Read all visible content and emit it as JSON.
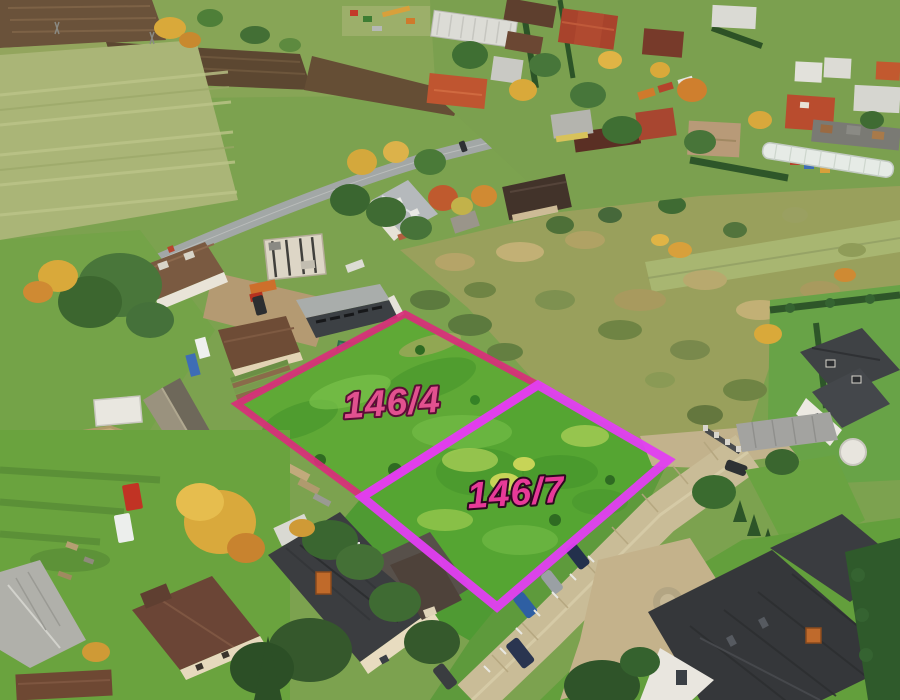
{
  "scene": {
    "type": "aerial-drone-photo",
    "subject": "building-plots-in-village"
  },
  "annotations": {
    "plots": [
      {
        "id": "146-4",
        "label": "146/4",
        "outline_color": "#d92e7b",
        "outline_width": "7",
        "label_fill": "#e2518f",
        "label_outline": "#5c0d36"
      },
      {
        "id": "146-7",
        "label": "146/7",
        "outline_color": "#e23ef2",
        "outline_width": "9",
        "label_fill": "#e73a98",
        "label_outline": "#2e0820"
      }
    ]
  }
}
